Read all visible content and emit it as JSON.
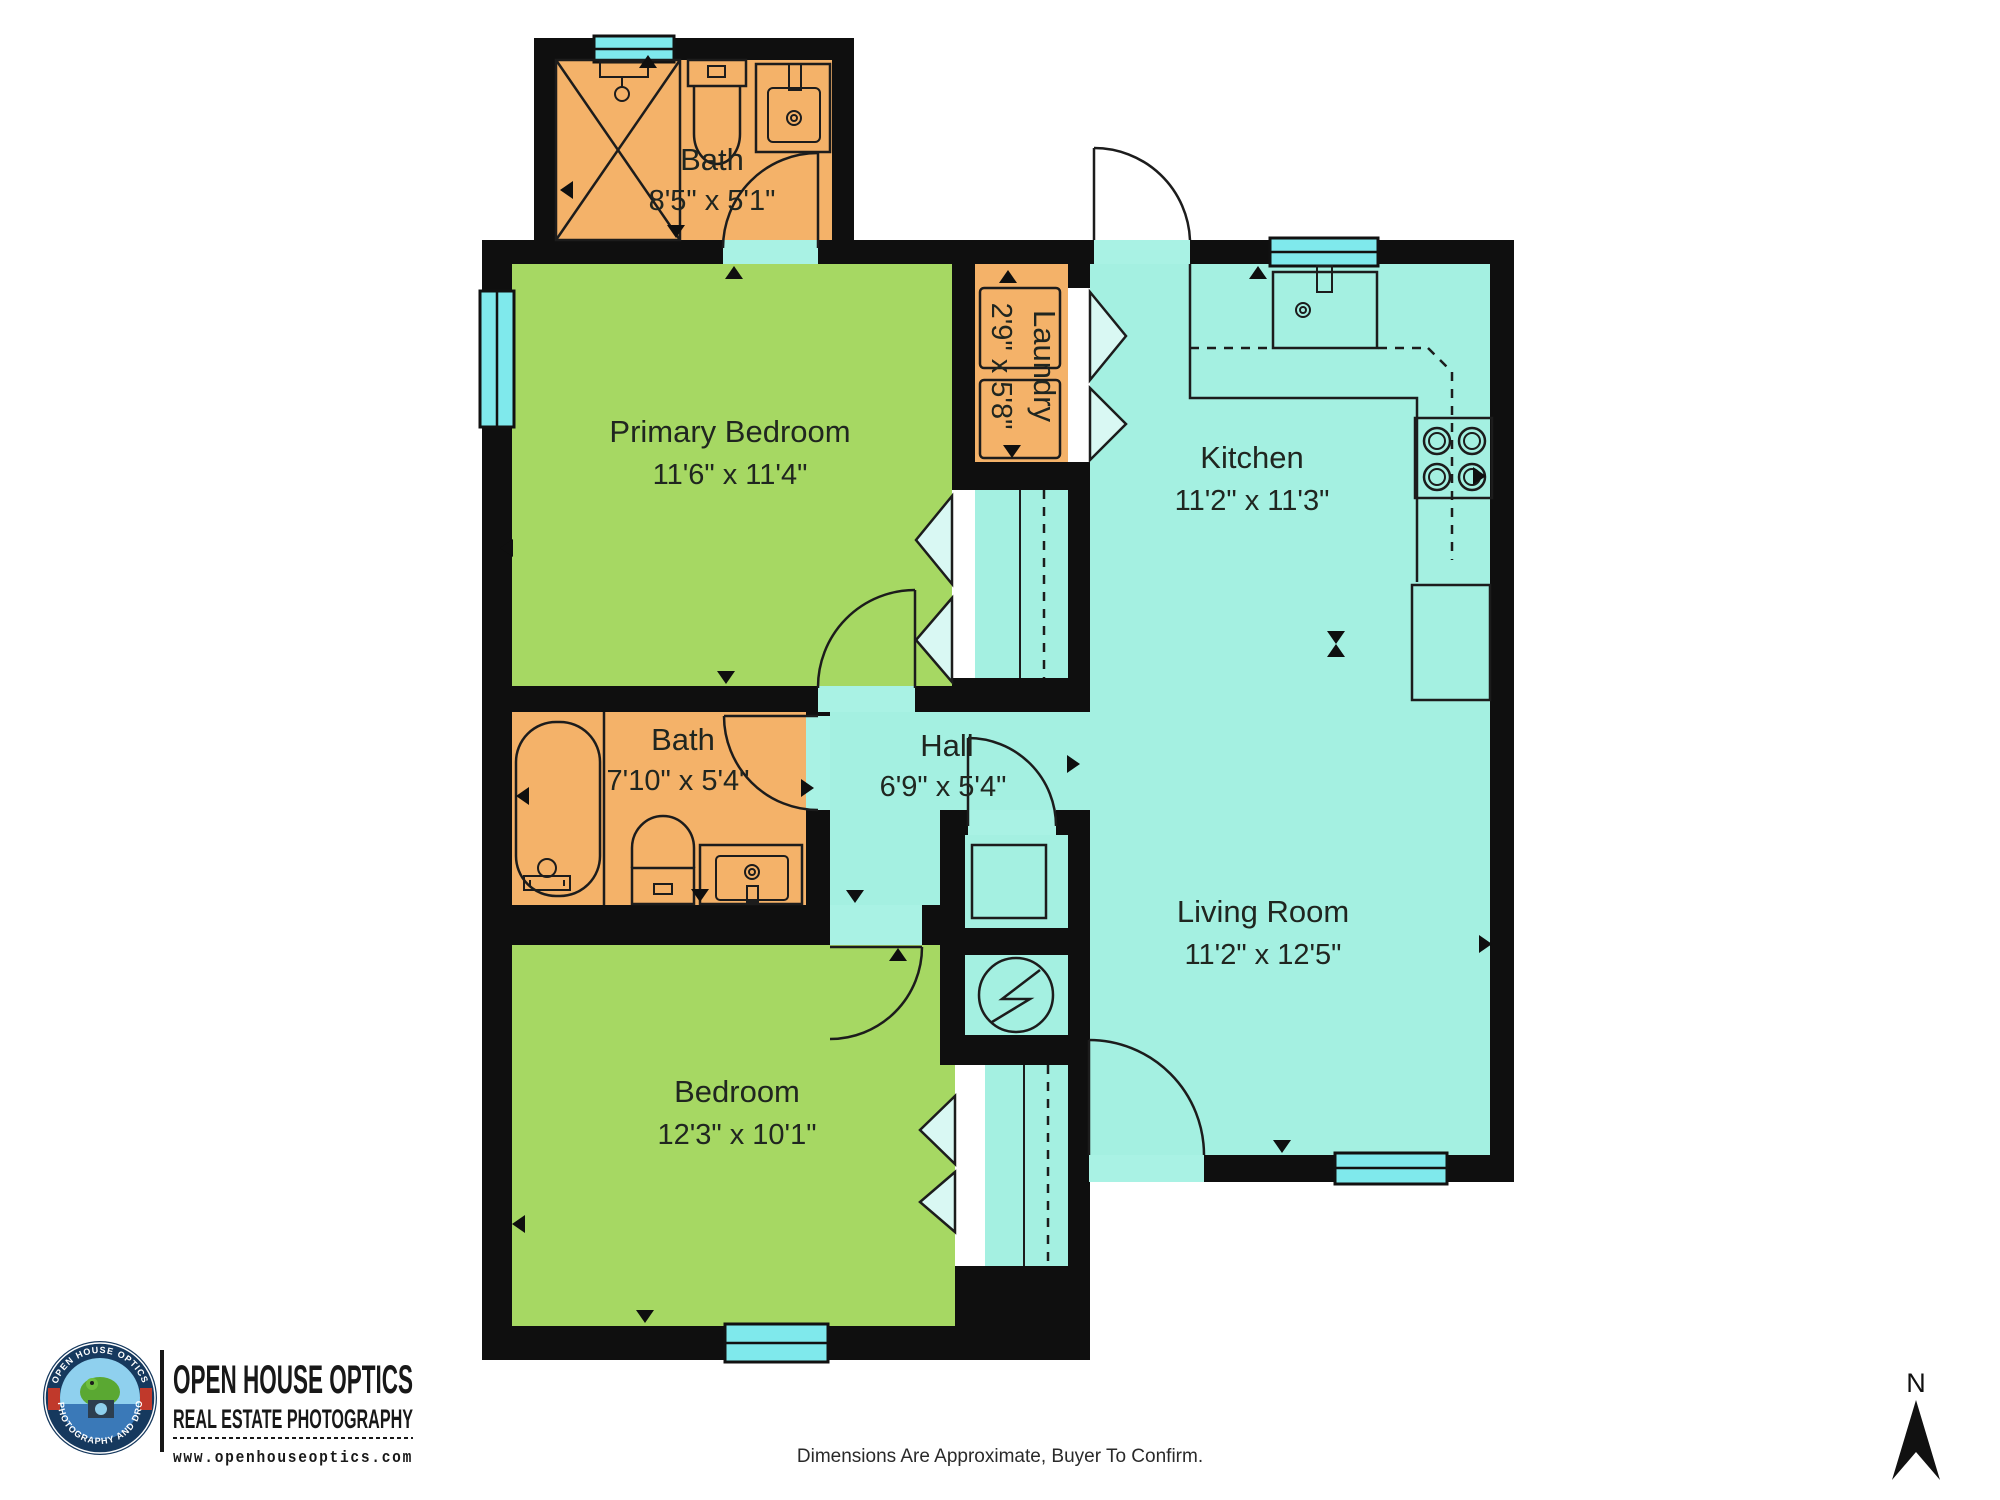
{
  "plan": {
    "rooms": [
      {
        "id": "bath-upper",
        "name": "Bath",
        "dims": "8'5\" x 5'1\""
      },
      {
        "id": "primary-bedroom",
        "name": "Primary Bedroom",
        "dims": "11'6\" x 11'4\""
      },
      {
        "id": "laundry",
        "name": "Laundry",
        "dims": "2'9\" x 5'8\""
      },
      {
        "id": "kitchen",
        "name": "Kitchen",
        "dims": "11'2\" x 11'3\""
      },
      {
        "id": "bath-hall",
        "name": "Bath",
        "dims": "7'10\" x 5'4\""
      },
      {
        "id": "hall",
        "name": "Hall",
        "dims": "6'9\" x 5'4\""
      },
      {
        "id": "living-room",
        "name": "Living Room",
        "dims": "11'2\" x 12'5\""
      },
      {
        "id": "bedroom",
        "name": "Bedroom",
        "dims": "12'3\" x 10'1\""
      }
    ],
    "fixtures": [
      "shower",
      "toilet",
      "sink-vanity",
      "bathtub",
      "washer",
      "dryer",
      "kitchen-sink",
      "stove-cooktop",
      "refrigerator",
      "kitchen-counter",
      "water-heater",
      "furnace",
      "closet-rod",
      "bifold-doors"
    ],
    "colors": {
      "wall": "#0f0f0f",
      "bathroom_floor": "#f4b269",
      "bedroom_floor": "#a6d863",
      "living_floor": "#a4f0e1",
      "window": "#7fe9ec",
      "label_text": "#202620"
    }
  },
  "footer": {
    "disclaimer": "Dimensions Are Approximate, Buyer To Confirm."
  },
  "branding": {
    "company": "OPEN HOUSE OPTICS",
    "tagline": "REAL ESTATE PHOTOGRAPHY",
    "website": "www.openhouseoptics.com",
    "badge_top": "OPEN HOUSE OPTICS",
    "badge_bottom": "3D PHOTOGRAPHY AND DRONE"
  },
  "compass": {
    "north_label": "N"
  }
}
